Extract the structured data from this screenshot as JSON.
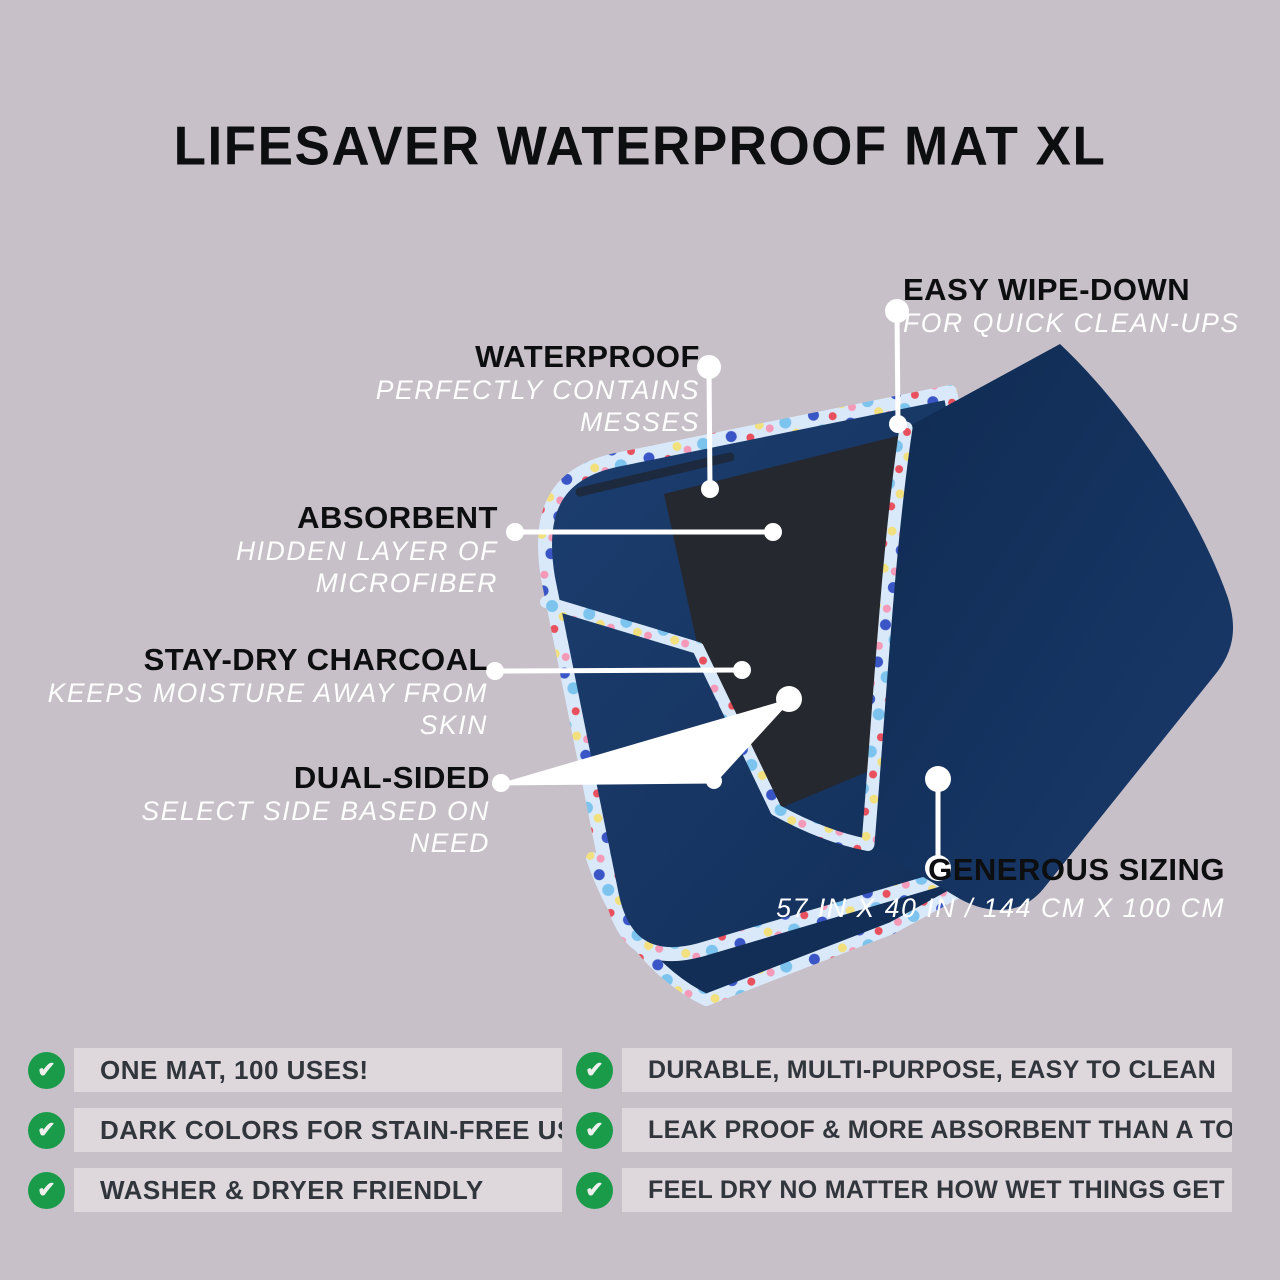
{
  "title": "LIFESAVER WATERPROOF MAT XL",
  "callouts": {
    "easy_wipe_down": {
      "heading": "EASY WIPE-DOWN",
      "subheading": "FOR QUICK CLEAN-UPS"
    },
    "waterproof": {
      "heading": "WATERPROOF",
      "subheading": "PERFECTLY CONTAINS MESSES"
    },
    "absorbent": {
      "heading": "ABSORBENT",
      "subheading": "HIDDEN LAYER OF MICROFIBER"
    },
    "stay_dry_charcoal": {
      "heading": "STAY-DRY CHARCOAL",
      "subheading": "KEEPS MOISTURE AWAY FROM SKIN"
    },
    "dual_sided": {
      "heading": "DUAL-SIDED",
      "subheading": "SELECT SIDE BASED ON NEED"
    },
    "generous_sizing": {
      "heading": "GENEROUS SIZING",
      "subheading": "57 IN X 40 IN  / 144 CM X 100 CM"
    }
  },
  "features": {
    "left": [
      "ONE MAT, 100 USES!",
      "DARK COLORS FOR STAIN-FREE USE",
      "WASHER & DRYER FRIENDLY"
    ],
    "right": [
      "DURABLE, MULTI-PURPOSE, EASY TO CLEAN",
      "LEAK PROOF & MORE ABSORBENT THAN A TOWEL",
      "FEEL DRY NO MATTER HOW WET THINGS GET"
    ]
  },
  "icons": {
    "check": "✔"
  },
  "colors": {
    "background": "#c8c0c8",
    "row_strip": "#ded8dd",
    "check_green": "#1a9b4a",
    "mat_navy": "#16345f",
    "mat_charcoal": "#25282e",
    "trim_pale_blue": "#d9e9fa",
    "callout_heading": "#0d0e10",
    "callout_subheading": "#ffffff",
    "feature_text": "#31353c",
    "connector": "#ffffff"
  }
}
